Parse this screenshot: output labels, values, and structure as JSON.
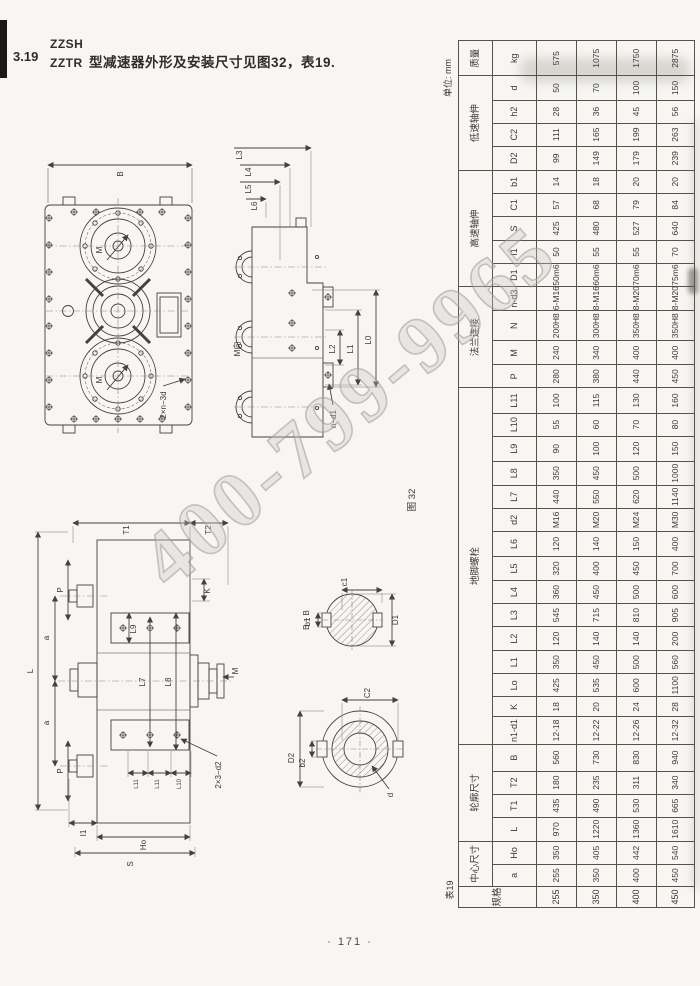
{
  "page": {
    "section_number": "3.19",
    "model_line1": "ZZSH",
    "model_line2": "ZZTR",
    "title": "型减速器外形及安装尺寸见图32，表19.",
    "unit_note": "单位: mm",
    "figure_label": "图 32",
    "page_number": "· 171 ·",
    "watermark": "400-799-9965"
  },
  "drawings": {
    "front_view": {
      "width_dim": "B",
      "view_arrow": "M",
      "bolt_note": "2×n−3d"
    },
    "side_view": {
      "view_label": "M向",
      "top_dims": [
        "L3",
        "L4",
        "L5",
        "L6"
      ],
      "right_dims": [
        "L2",
        "L1",
        "L0"
      ],
      "bolt_note": "n−d1"
    },
    "plan_view": {
      "top_dims": [
        "T1",
        "T2"
      ],
      "left_dims": [
        "P",
        "a",
        "L",
        "a",
        "P"
      ],
      "inner_dims": [
        "L9",
        "L7",
        "L8"
      ],
      "small_dims": [
        "L11",
        "L11",
        "L10"
      ],
      "bottom_dims": [
        "I1",
        "Ho",
        "S"
      ],
      "side_dims": [
        "K",
        "M"
      ],
      "bolt_note": "2×3−d2"
    },
    "section_bb": {
      "title": "B − B",
      "width_dim": "c1",
      "key_dim": "b1",
      "dia_dim": "D1"
    },
    "shaft_end_view": {
      "outer_dim": "C2",
      "key_dim": "b2",
      "dia_dim": "D2",
      "bore_dim": "d"
    }
  },
  "table": {
    "tag": "表19",
    "col_groups": [
      {
        "label": "规格",
        "span": 1
      },
      {
        "label": "中心尺寸",
        "span": 2
      },
      {
        "label": "轮廓尺寸",
        "span": 4
      },
      {
        "label": "地脚螺栓",
        "span": 15
      },
      {
        "label": "法兰连接",
        "span": 4
      },
      {
        "label": "高速轴伸",
        "span": 5
      },
      {
        "label": "低速轴伸",
        "span": 4
      },
      {
        "label": "质量",
        "span": 1
      }
    ],
    "sub_headers": [
      "a",
      "Ho",
      "L",
      "T1",
      "T2",
      "B",
      "n1-d1",
      "K",
      "Lo",
      "L1",
      "L2",
      "L3",
      "L4",
      "L5",
      "L6",
      "d2",
      "L7",
      "L8",
      "L9",
      "L10",
      "L11",
      "P",
      "M",
      "N",
      "n-d3",
      "D1",
      "I1",
      "S",
      "C1",
      "b1",
      "D2",
      "C2",
      "h2",
      "d",
      "kg"
    ],
    "rows": [
      {
        "spec": "255",
        "values": [
          "255",
          "350",
          "970",
          "435",
          "180",
          "560",
          "12-18",
          "18",
          "425",
          "350",
          "120",
          "545",
          "360",
          "320",
          "120",
          "M16",
          "440",
          "350",
          "90",
          "55",
          "100",
          "280",
          "240",
          "200H8",
          "6-M16",
          "50m6",
          "50",
          "425",
          "57",
          "14",
          "99",
          "111",
          "28",
          "50",
          "575"
        ]
      },
      {
        "spec": "350",
        "values": [
          "350",
          "405",
          "1220",
          "490",
          "235",
          "730",
          "12-22",
          "20",
          "535",
          "450",
          "140",
          "715",
          "450",
          "400",
          "140",
          "M20",
          "550",
          "450",
          "100",
          "60",
          "115",
          "380",
          "340",
          "300H8",
          "8-M16",
          "60m6",
          "55",
          "480",
          "68",
          "18",
          "149",
          "165",
          "36",
          "70",
          "1075"
        ]
      },
      {
        "spec": "400",
        "values": [
          "400",
          "442",
          "1360",
          "530",
          "311",
          "830",
          "12-26",
          "24",
          "600",
          "500",
          "140",
          "810",
          "500",
          "450",
          "150",
          "M24",
          "620",
          "500",
          "120",
          "70",
          "130",
          "440",
          "400",
          "350H8",
          "8-M20",
          "70m6",
          "55",
          "527",
          "79",
          "20",
          "179",
          "199",
          "45",
          "100",
          "1750"
        ]
      },
      {
        "spec": "450",
        "values": [
          "450",
          "540",
          "1610",
          "665",
          "340",
          "940",
          "12-32",
          "28",
          "1100",
          "560",
          "200",
          "905",
          "600",
          "700",
          "400",
          "M30",
          "1140",
          "1000",
          "150",
          "80",
          "160",
          "450",
          "400",
          "350H8",
          "8-M20",
          "75m6",
          "70",
          "640",
          "84",
          "20",
          "239",
          "263",
          "56",
          "150",
          "2875"
        ]
      }
    ]
  }
}
